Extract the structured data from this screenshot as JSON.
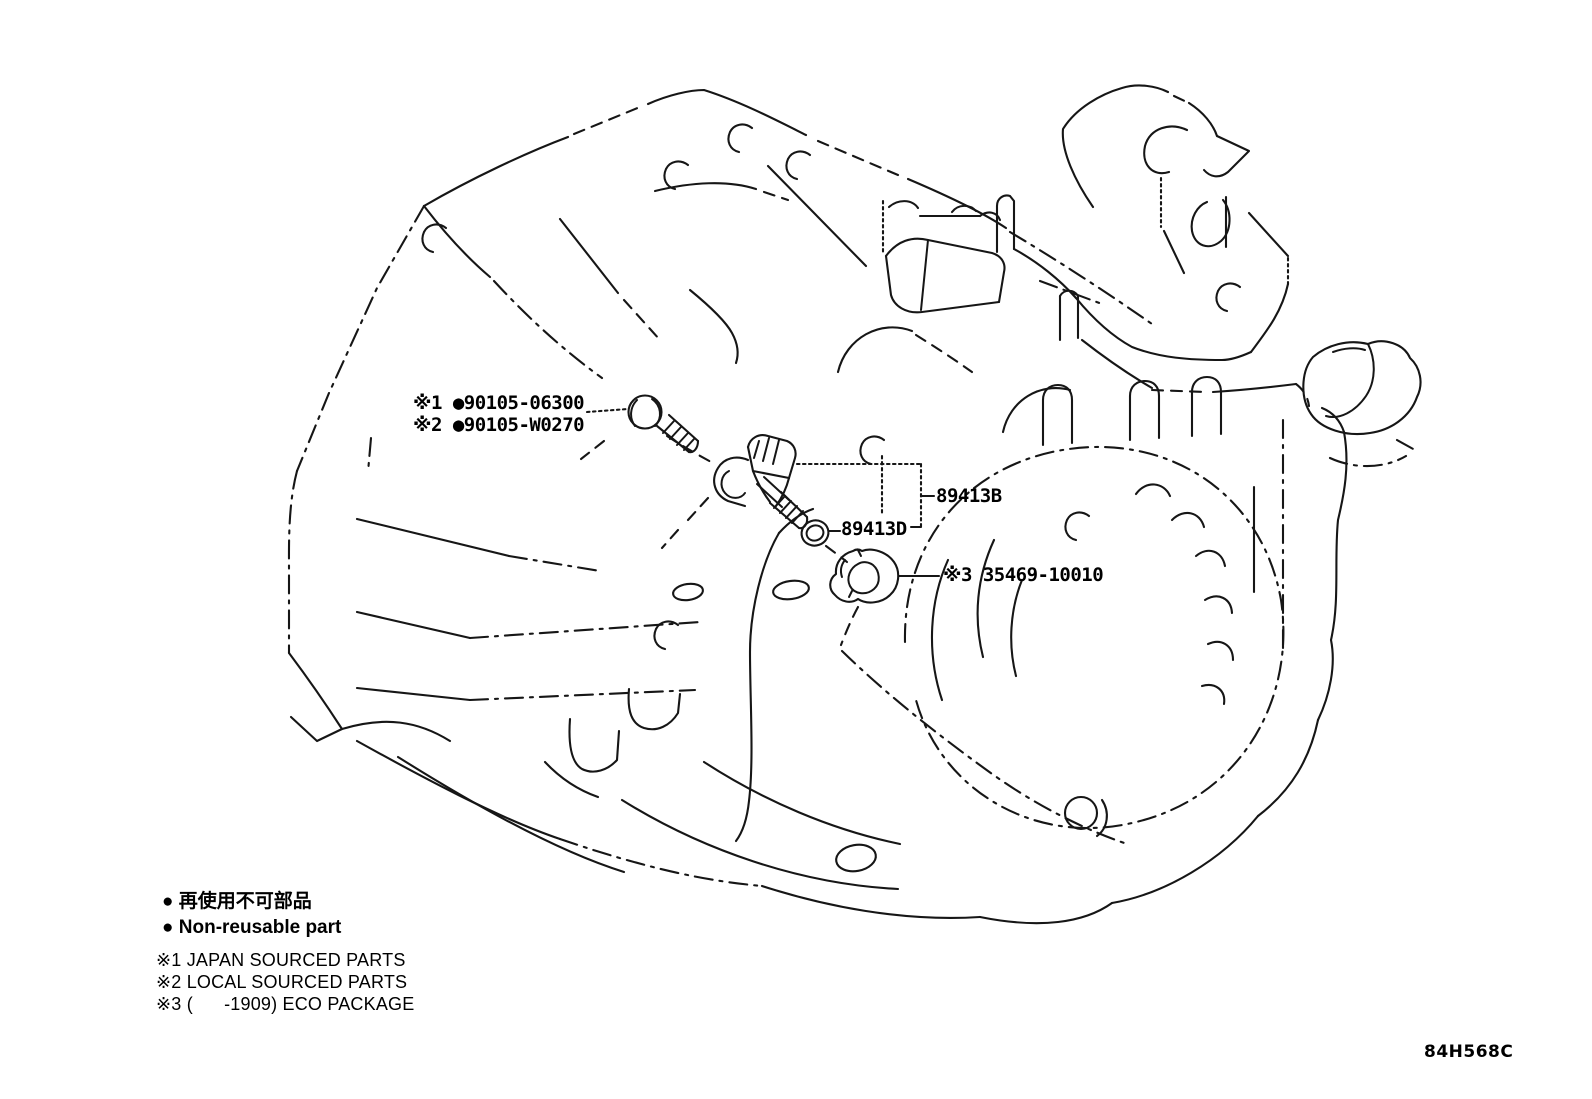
{
  "figure": {
    "type": "parts-diagram",
    "subject": "transaxle speed sensor",
    "code": "84H568C"
  },
  "callouts": {
    "bolt_line1": "※1 ●90105-06300",
    "bolt_line2": "※2 ●90105-W0270",
    "speed_sensor_label": "89413B",
    "o_ring_label": "89413D",
    "plug_label": "※3 35469-10010"
  },
  "parts": [
    {
      "part_number": "90105-06300",
      "marker": "※1",
      "non_reusable": true,
      "component": "bolt"
    },
    {
      "part_number": "90105-W0270",
      "marker": "※2",
      "non_reusable": true,
      "component": "bolt"
    },
    {
      "part_number": "89413B",
      "marker": "",
      "non_reusable": false,
      "component": "speed-sensor"
    },
    {
      "part_number": "89413D",
      "marker": "",
      "non_reusable": false,
      "component": "o-ring"
    },
    {
      "part_number": "35469-10010",
      "marker": "※3",
      "non_reusable": false,
      "component": "plug"
    }
  ],
  "legend": {
    "non_reusable_jp": "● 再使用不可部品",
    "non_reusable_en": "● Non-reusable part",
    "note_1": "※1 JAPAN SOURCED PARTS",
    "note_2": "※2 LOCAL SOURCED PARTS",
    "note_3": "※3 (      -1909) ECO PACKAGE"
  },
  "colors": {
    "line": "#161616",
    "background": "#ffffff"
  }
}
